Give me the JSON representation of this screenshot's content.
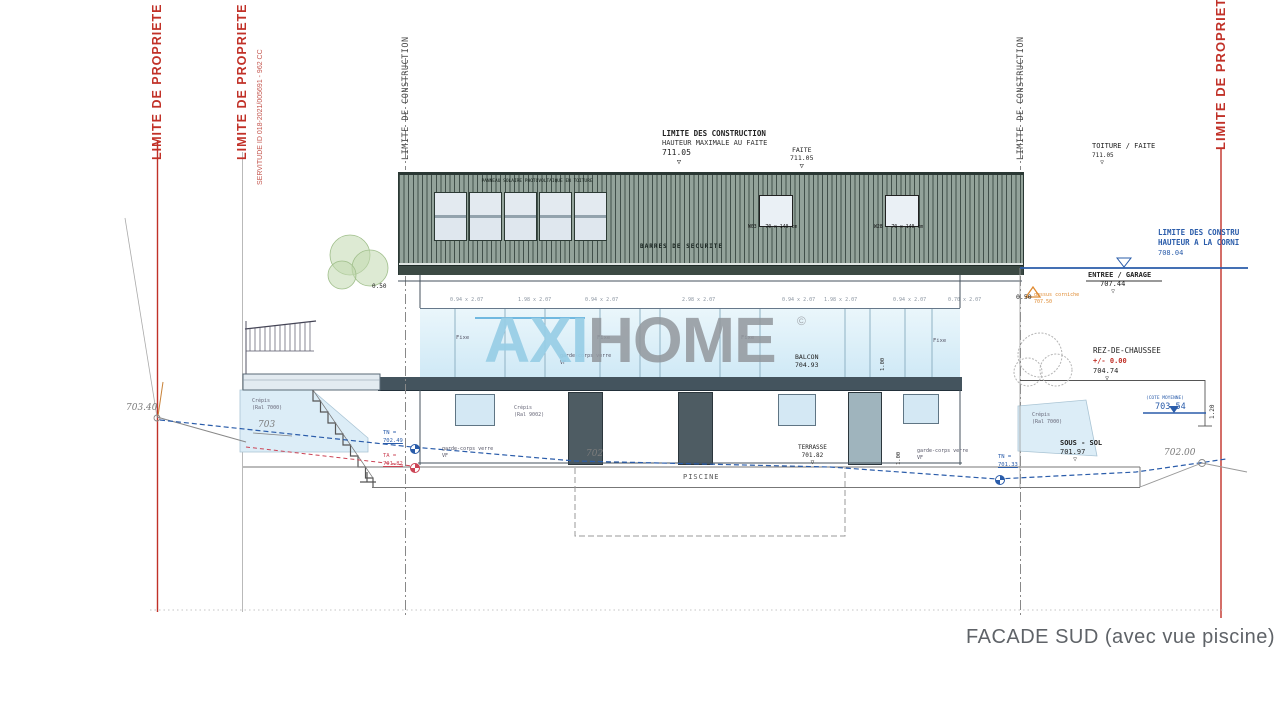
{
  "colors": {
    "red": "#c13128",
    "blue": "#2a5caa",
    "orange": "#df8a30",
    "roof": "#93a39a",
    "slab": "#44545e",
    "glass": "#d2eaf6"
  },
  "symbols": {
    "tri_open": "▽",
    "tri_solid": "▼",
    "copyright": "©"
  },
  "footer": {
    "caption": "FACADE SUD (avec vue piscine)"
  },
  "watermark": {
    "axi": "AXI",
    "home": "HOME"
  },
  "limits": {
    "propriete": "LIMITE DE PROPRIETE",
    "servitude": "SERVITUDE ID 018-2021/005691 - 962 CC",
    "construction": "LIMITE DE CONSTRUCTION"
  },
  "levels": {
    "max": {
      "l1": "LIMITE DES CONSTRUCTION",
      "l2": "HAUTEUR MAXIMALE AU FAITE",
      "v": "711.05"
    },
    "faite": {
      "l": "FAITE",
      "v": "711.05"
    },
    "toiture": {
      "l": "TOITURE / FAITE",
      "v": "711.05"
    },
    "corniche": {
      "l1": "LIMITE DES CONSTRU",
      "l2": "HAUTEUR A LA CORNI",
      "v": "708.04"
    },
    "entree": {
      "l": "ENTREE / GARAGE",
      "v": "707.44"
    },
    "corniche_note": {
      "dim": "0.50",
      "n1": "dessus corniche",
      "v": "707.50"
    },
    "rdc": {
      "l": "REZ-DE-CHAUSSEE",
      "rel": "+/- 0.00",
      "v": "704.74"
    },
    "cote_moyenne": {
      "l": "(COTE MOYENNE)",
      "v": "703.54"
    },
    "sous_sol": {
      "l": "SOUS - SOL",
      "v": "701.97"
    },
    "balcon": {
      "l": "BALCON",
      "v": "704.93"
    },
    "terrasse": {
      "l": "TERRASSE",
      "v": "701.82"
    },
    "tn_left": {
      "l": "TN =",
      "v": "702.49"
    },
    "ta_left": {
      "l": "TA =",
      "v": "701.82"
    },
    "tn_right": {
      "l": "TN =",
      "v": "701.33"
    },
    "hand_70340": "703.40",
    "hand_703": "703",
    "hand_702": "702",
    "hand_70200": "702.00"
  },
  "dims": {
    "d050_left": "0.50",
    "d100_balcony": "1.00",
    "d100_terrace": "1.00",
    "d120": "1.20",
    "window_row": [
      "0.94 x 2.07",
      "1.98 x 2.07",
      "0.94 x 2.07",
      "2.98 x 2.07",
      "0.94 x 2.07",
      "1.98 x 2.07",
      "0.94 x 2.07",
      "0.70 x 2.07"
    ]
  },
  "building": {
    "panneau_note": "PANNEAU SOLAIRE PHOTOVOLTAIQUE EN TOITURE",
    "barres": "BARRES DE SECURITE",
    "w03": "W03 - 70 x 140 cm",
    "w28": "W28 - 70 x 140 cm",
    "fixe": "Fixe",
    "garde_corps": "garde-corps verre",
    "vf": "VF",
    "crepis": "Crépis",
    "ral9002": "(Ral 9002)",
    "ral7000": "(Ral 7000)",
    "piscine": "PISCINE"
  }
}
